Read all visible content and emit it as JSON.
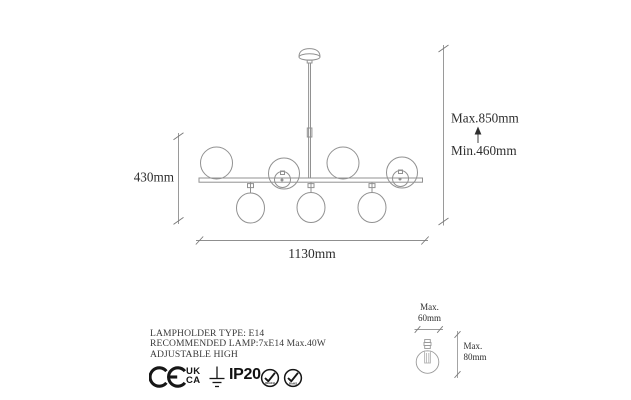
{
  "title": "Chandelier technical dimension drawing",
  "colors": {
    "background": "#ffffff",
    "drawing_line": "#919191",
    "dimension_line": "#8f8f8f",
    "text": "#2e2e2e",
    "icon": "#161616"
  },
  "dimensions": {
    "fixture_height": "430mm",
    "fixture_width": "1130mm",
    "hanging_max": "Max.850mm",
    "hanging_min": "Min.460mm"
  },
  "bulb": {
    "width_label": "Max.",
    "width_value": "60mm",
    "height_label": "Max.",
    "height_value": "80mm"
  },
  "specs": {
    "rows": [
      {
        "label": "LAMPHOLDER TYPE",
        "value": ": E14"
      },
      {
        "label": "RECOMMENDED LAMP:",
        "value": "7xE14 Max.40W"
      },
      {
        "label": "ADJUSTABLE HIGH",
        "value": ""
      }
    ]
  },
  "certifications": {
    "ce": "CE",
    "ukca_top": "UK",
    "ukca_bottom": "CA",
    "earth_icon": "earth-ground-symbol",
    "ip_rating": "IP20",
    "badge_reach": "REACH",
    "badge_rohs": "RoHS"
  }
}
